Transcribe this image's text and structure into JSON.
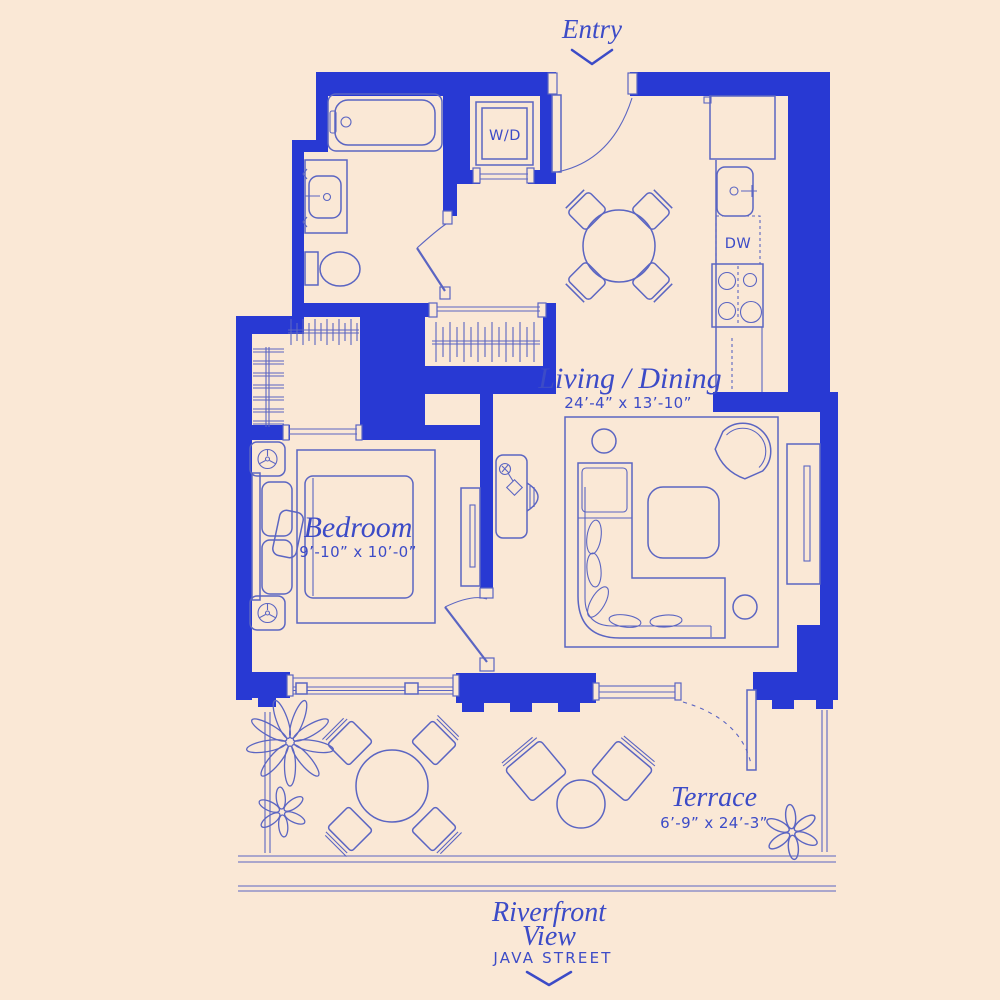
{
  "colors": {
    "background": "#fae8d6",
    "wall": "#2839d3",
    "line": "#5b65c2",
    "text": "#3c4bc7"
  },
  "labels": {
    "entry": "Entry",
    "washer_dryer": "W/D",
    "dishwasher": "DW",
    "living_dining": {
      "name": "Living / Dining",
      "dimensions": "24’-4” x 13’-10”"
    },
    "bedroom": {
      "name": "Bedroom",
      "dimensions": "9’-10” x 10’-0”"
    },
    "terrace": {
      "name": "Terrace",
      "dimensions": "6’-9” x 24’-3”"
    },
    "riverfront": {
      "line1": "Riverfront",
      "line2": "View"
    },
    "street": "JAVA STREET"
  }
}
